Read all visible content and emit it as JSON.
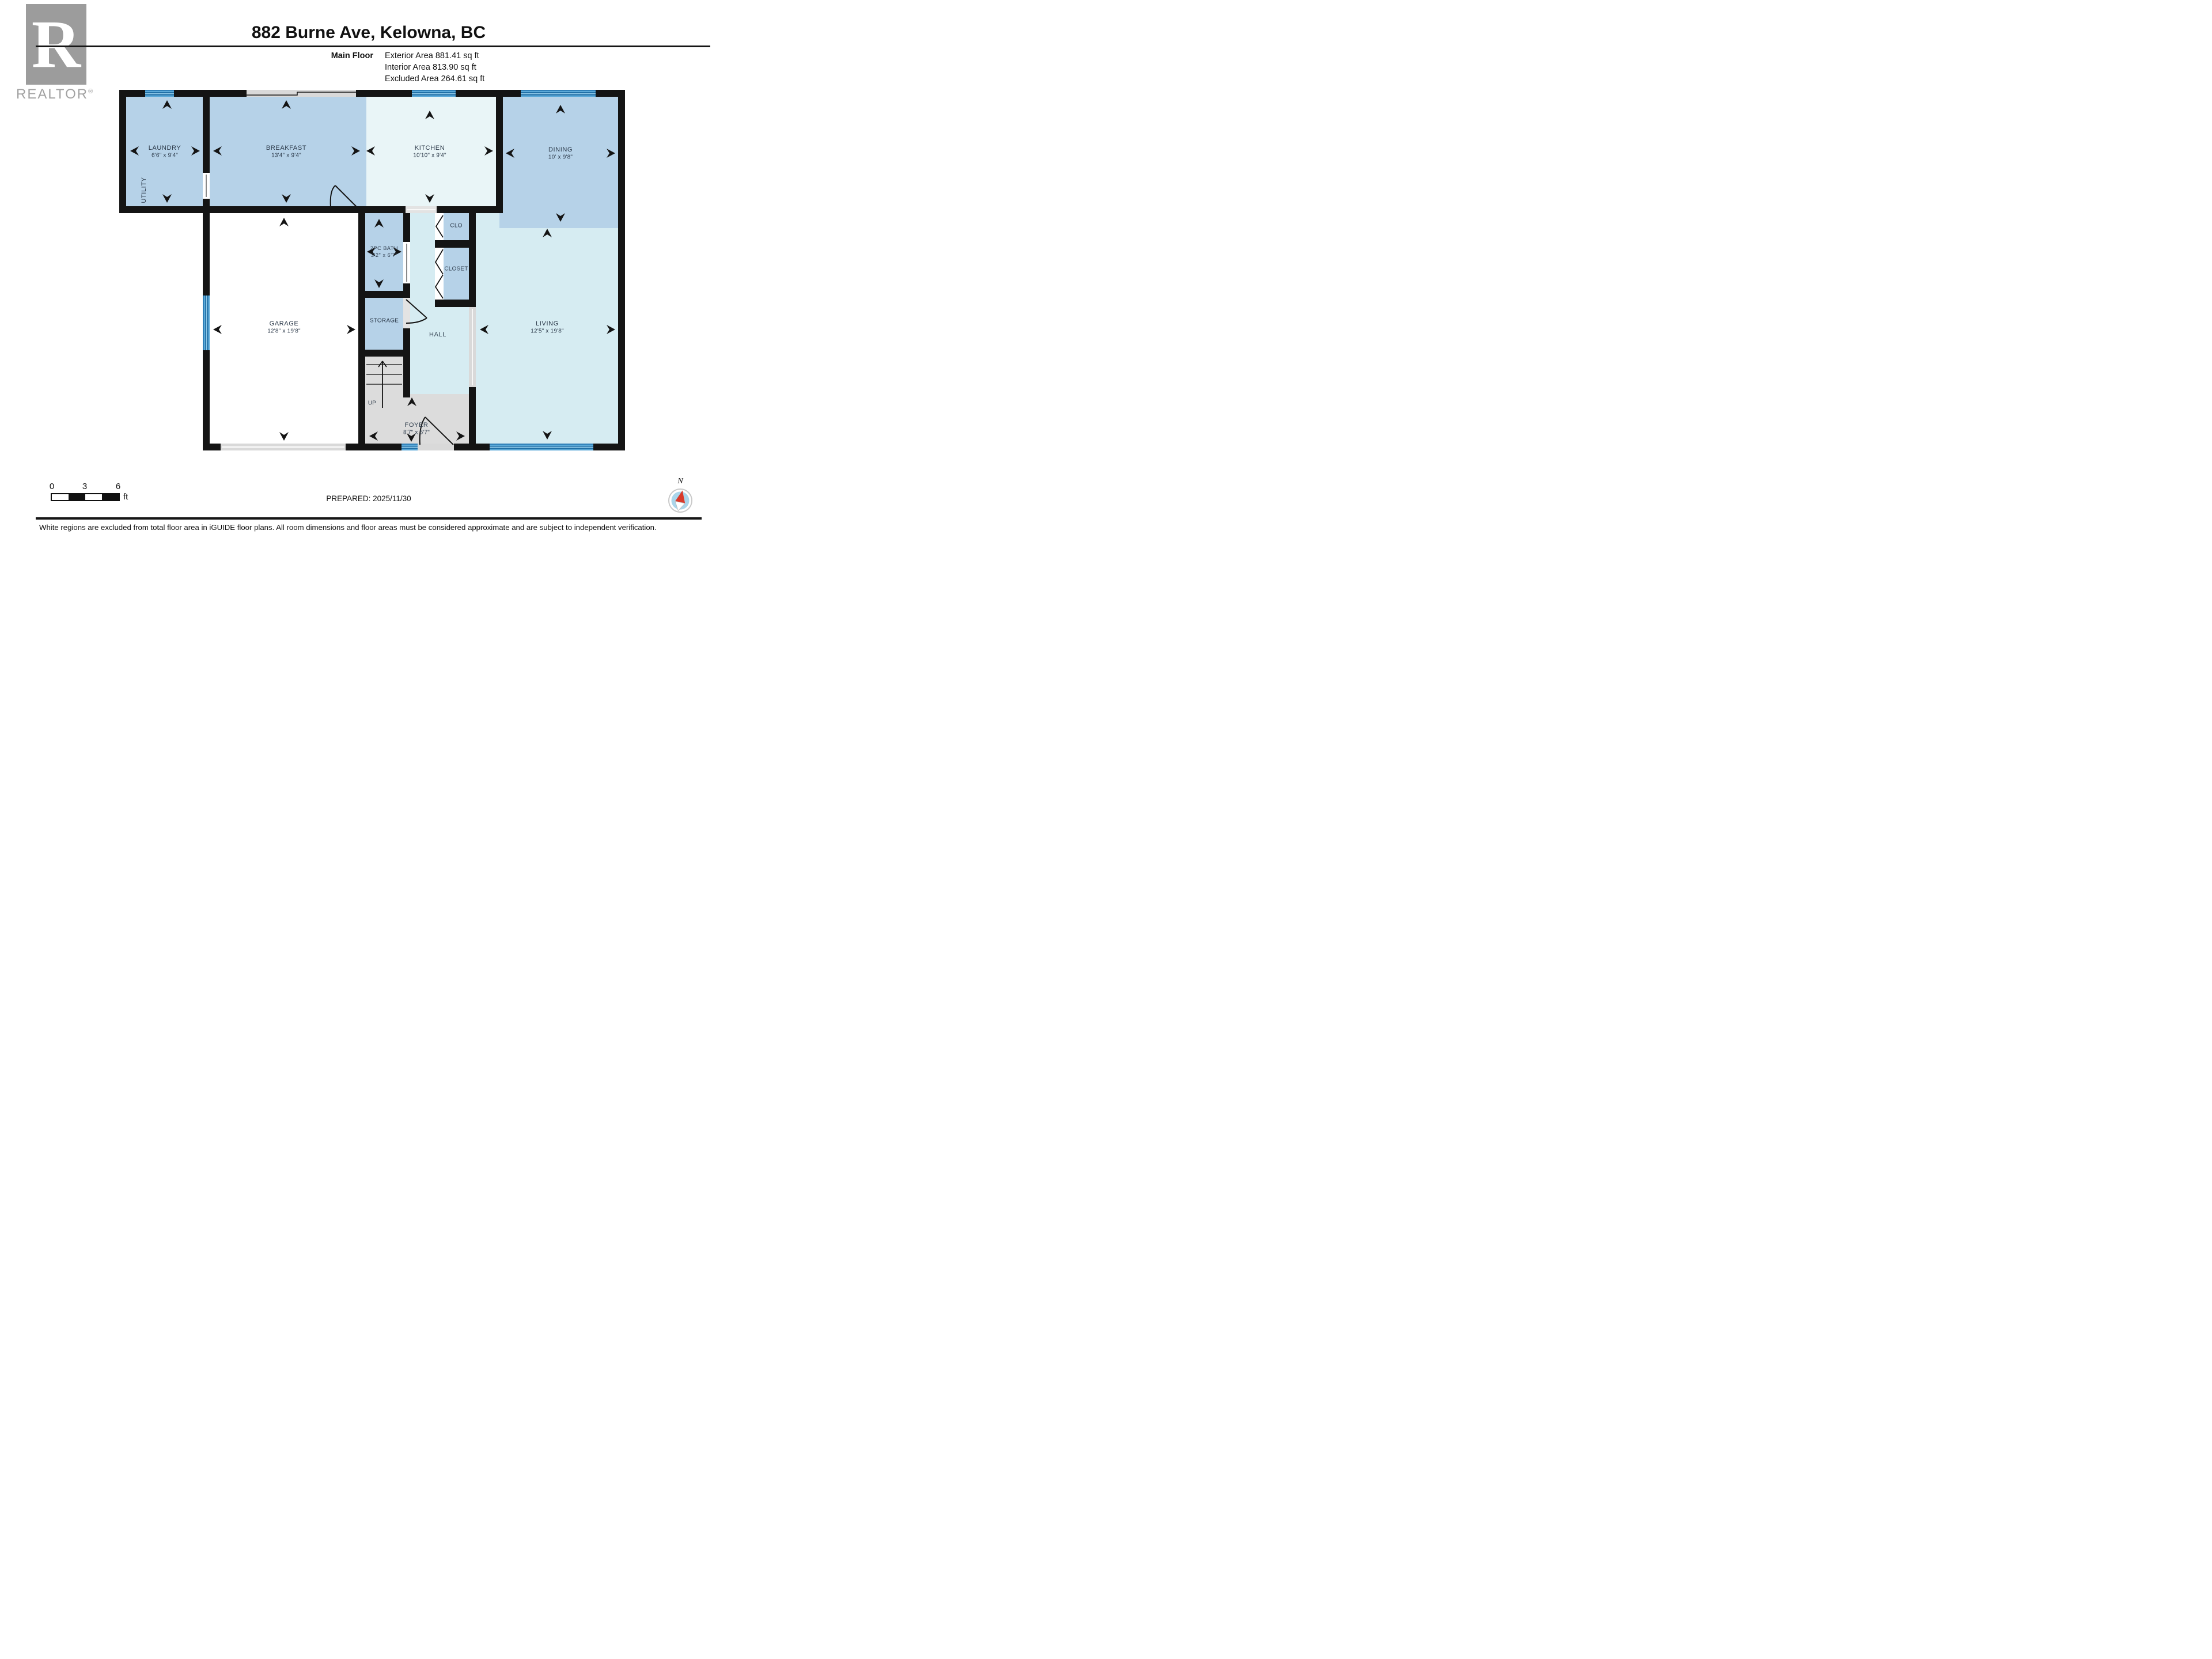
{
  "branding": {
    "logo_letter": "R",
    "logo_word": "REALTOR",
    "registered": "®"
  },
  "header": {
    "title": "882 Burne Ave, Kelowna, BC",
    "floor_label": "Main Floor",
    "exterior": "Exterior Area 881.41 sq ft",
    "interior": "Interior Area 813.90 sq ft",
    "excluded": "Excluded Area 264.61 sq ft"
  },
  "rooms": {
    "laundry": {
      "label": "LAUNDRY",
      "dims": "6'6\" x 9'4\""
    },
    "utility": {
      "label": "UTILITY"
    },
    "breakfast": {
      "label": "BREAKFAST",
      "dims": "13'4\" x 9'4\""
    },
    "kitchen": {
      "label": "KITCHEN",
      "dims": "10'10\" x 9'4\""
    },
    "dining": {
      "label": "DINING",
      "dims": "10' x 9'8\""
    },
    "bath": {
      "label": "2PC BATH",
      "dims": "3'2\" x 6'7\""
    },
    "storage": {
      "label": "STORAGE"
    },
    "hall": {
      "label": "HALL"
    },
    "clo": {
      "label": "CLO"
    },
    "closet": {
      "label": "CLOSET"
    },
    "garage": {
      "label": "GARAGE",
      "dims": "12'8\" x 19'8\""
    },
    "living": {
      "label": "LIVING",
      "dims": "12'5\" x 19'8\""
    },
    "foyer": {
      "label": "FOYER",
      "dims": "8'7\" x 5'7\""
    },
    "stairs": {
      "label": "UP"
    }
  },
  "footer": {
    "scale_start": "0",
    "scale_mid": "3",
    "scale_end": "6",
    "scale_unit": "ft",
    "prepared": "PREPARED: 2025/11/30",
    "compass": "N",
    "disclaimer": "White regions are excluded from total floor area in iGUIDE floor plans. All room dimensions and floor areas must be considered approximate and are subject to independent verification."
  },
  "colors": {
    "room_blue": "#b6d2e8",
    "room_pale": "#e9f5f7",
    "room_cyan": "#d6ecf2",
    "excluded_gray": "#dcdcdc",
    "wall": "#141414",
    "window_blue": "#5aa9d8",
    "label_text": "#2c3a4a",
    "compass_red": "#d93a2b"
  }
}
